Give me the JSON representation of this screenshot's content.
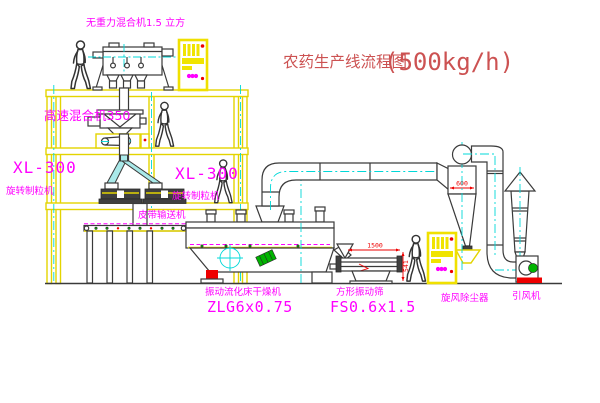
{
  "title": {
    "text": "农药生产线流程图",
    "capacity": "(500kg/h)"
  },
  "equipment": {
    "gravity_mixer": "无重力混合机1.5 立方",
    "high_speed_mixer": "高速混合机350",
    "granulator_left_model": "XL-300",
    "granulator_left_name": "旋转制粒机",
    "granulator_right_model": "XL-300",
    "granulator_right_name": "旋转制粒机",
    "belt_conveyor": "皮带输送机",
    "dryer_name": "振动流化床干燥机",
    "dryer_model": "ZLG6x0.75",
    "screen_name": "方形振动筛",
    "screen_model": "FS0.6x1.5",
    "cyclone_name": "旋风除尘器",
    "fan_name": "引风机"
  },
  "dimensions": {
    "screen_length": "1500",
    "screen_height": "541",
    "cyclone_dia": "600"
  },
  "colors": {
    "line_yellow": "#e3d400",
    "centerline_cyan": "#00d8d8",
    "label_magenta": "#ff00ff",
    "title_red": "#cc5252",
    "dim_red": "#ee0000",
    "line_dark": "#3a3a3a",
    "machine_green": "#00b400"
  }
}
